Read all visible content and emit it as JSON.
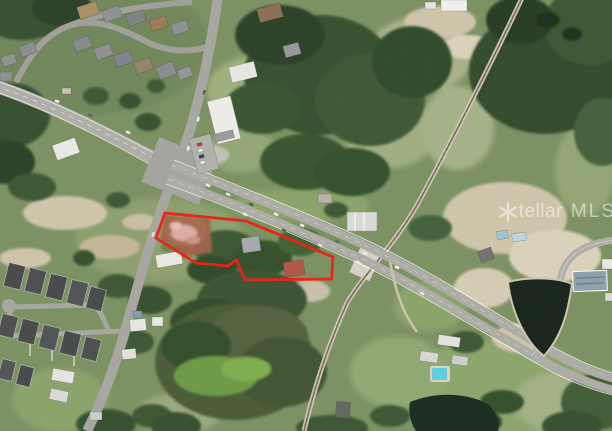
{
  "page": {
    "title": "Satellite aerial listing photo",
    "description": "Aerial view of a highway intersection area with a red property boundary outline"
  },
  "watermark": {
    "brand": "Stellar MLS",
    "text_left": "tellar",
    "text_right": "MLS",
    "color": "#ffffff",
    "opacity": 0.52
  },
  "property_boundary": {
    "color": "#e8231a",
    "stroke_width": 2.8,
    "points_str": "165,213 246,221 333,257 331.5,279 245,280 236.5,260 228,266 196,263 156,238",
    "shape": "irregular-polygon"
  },
  "map": {
    "type": "satellite-aerial",
    "features": {
      "highway": "divided highway running NW to SE through a signalized intersection",
      "cross_road": "two-lane road running N to S through intersection",
      "railroad": "rail corridor running NE to SW east of the parcel",
      "parcel": "cleared red-dirt lot with rubble inside red boundary",
      "ponds": "dark retention pond at right and dark pond at bottom center",
      "neighborhoods": "residential subdivisions at top-left and bottom-left",
      "pool": "small bright blue swimming pool south of highway"
    }
  }
}
